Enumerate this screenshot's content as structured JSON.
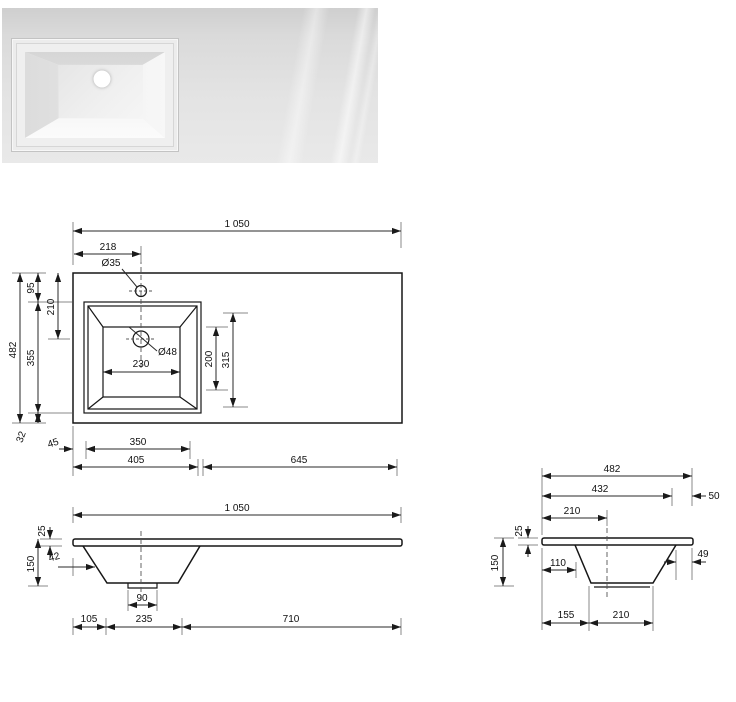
{
  "colors": {
    "line": "#161616",
    "dim_text": "#111111",
    "photo_bg": "#dadada"
  },
  "photo": {
    "subject": "white-basin-top-view"
  },
  "plan": {
    "total_width": "1 050",
    "faucet_offset": "218",
    "faucet_dia": "Ø35",
    "drain_dia": "Ø48",
    "bowl_inner_width": "230",
    "bowl_inner_len": "200",
    "bowl_outer_len": "315",
    "depth": "482",
    "edge_to_bowl": "95",
    "edge_to_drain": "210",
    "bowl_depth": "355",
    "bowl_to_front": "32",
    "left_margin": "45",
    "bowl_width": "350",
    "left_section": "405",
    "right_section": "645"
  },
  "front": {
    "total_width": "1 050",
    "top_thickness": "25",
    "height": "150",
    "slope_offset": "42",
    "drain_width": "90",
    "left_margin": "105",
    "bowl_bottom_width": "235",
    "right_section": "710"
  },
  "side": {
    "depth": "482",
    "front_section": "432",
    "overhang": "50",
    "edge_to_center": "210",
    "top_thickness": "25",
    "height": "150",
    "slope_front": "110",
    "slope_back": "49",
    "front_margin": "155",
    "bottom_width": "210"
  }
}
